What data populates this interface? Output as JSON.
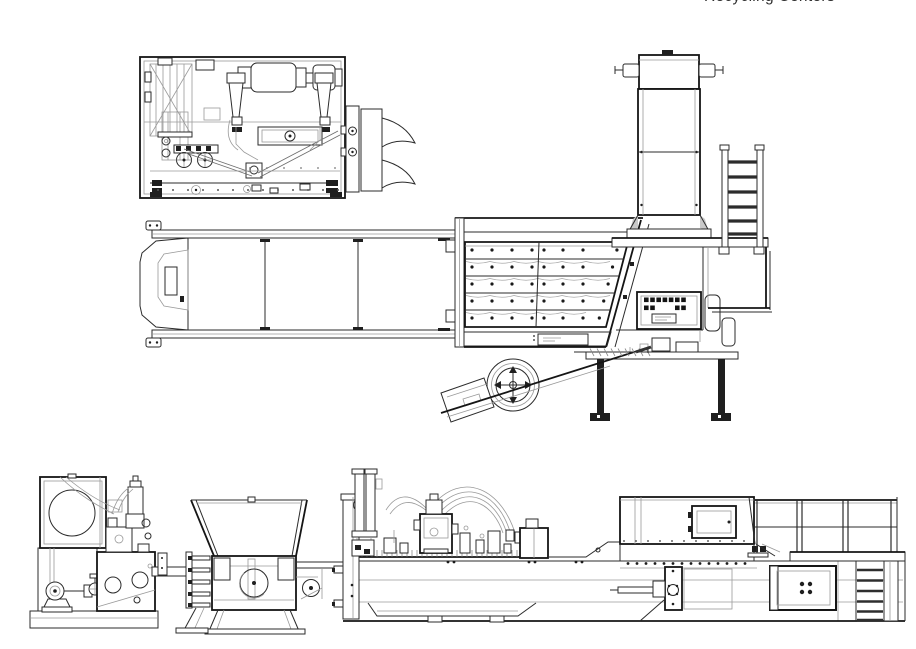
{
  "header": {
    "title": "Recycling Centers"
  },
  "drawing": {
    "background": "#ffffff",
    "line_color": "#2b2b2b",
    "heavy_line_color": "#151515",
    "detail_line_color": "#9a9a9a",
    "shading_color": "#c9c9c9"
  }
}
